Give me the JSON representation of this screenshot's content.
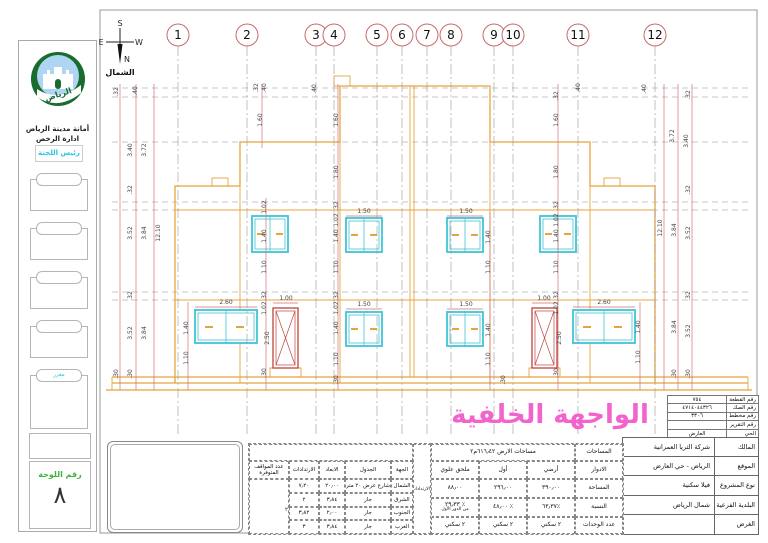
{
  "page": {
    "facade_title": "الواجهة الخلفية"
  },
  "sidebar": {
    "authority_line1": "أمانة مدينة الرياض",
    "authority_line2": "ادارة الرخص",
    "committee_head": "رئيس اللجنة",
    "logo_script": "الرياض",
    "stamp_tab_label": "مقرر"
  },
  "sheet_box": {
    "label": "رقم اللوحة",
    "number": "٨"
  },
  "compass": {
    "n": "N",
    "s": "S",
    "e": "E",
    "w": "W",
    "label": "الشمال"
  },
  "drawing": {
    "grid_bubbles": [
      {
        "n": "1",
        "x": 178
      },
      {
        "n": "2",
        "x": 247
      },
      {
        "n": "3",
        "x": 316
      },
      {
        "n": "4",
        "x": 334
      },
      {
        "n": "5",
        "x": 377
      },
      {
        "n": "6",
        "x": 402
      },
      {
        "n": "7",
        "x": 427
      },
      {
        "n": "8",
        "x": 451
      },
      {
        "n": "9",
        "x": 494
      },
      {
        "n": "10",
        "x": 513
      },
      {
        "n": "11",
        "x": 578
      },
      {
        "n": "12",
        "x": 655
      }
    ],
    "dim_labels": [
      [
        ".32",
        118,
        92,
        1
      ],
      [
        ".40",
        137,
        91,
        1
      ],
      [
        "3.40",
        132,
        150,
        1
      ],
      [
        "3.72",
        146,
        150,
        1
      ],
      [
        ".32",
        132,
        190,
        1
      ],
      [
        "3.52",
        132,
        233,
        1
      ],
      [
        "3.84",
        146,
        233,
        1
      ],
      [
        "12.10",
        160,
        233,
        1
      ],
      [
        ".32",
        132,
        296,
        1
      ],
      [
        "3.52",
        132,
        333,
        1
      ],
      [
        "3.84",
        146,
        333,
        1
      ],
      [
        ".30",
        132,
        374,
        1
      ],
      [
        ".30",
        118,
        374,
        1
      ],
      [
        ".32",
        690,
        95,
        1
      ],
      [
        ".40",
        646,
        89,
        1
      ],
      [
        ".40",
        580,
        88,
        1
      ],
      [
        "3.40",
        688,
        141,
        1
      ],
      [
        "3.72",
        674,
        136,
        1
      ],
      [
        ".32",
        690,
        190,
        1
      ],
      [
        "3.52",
        690,
        233,
        1
      ],
      [
        "3.84",
        676,
        230,
        1
      ],
      [
        "12.10",
        662,
        228,
        1
      ],
      [
        ".32",
        690,
        296,
        1
      ],
      [
        "3.52",
        690,
        331,
        1
      ],
      [
        "3.84",
        676,
        327,
        1
      ],
      [
        ".30",
        690,
        374,
        1
      ],
      [
        ".30",
        676,
        374,
        1
      ],
      [
        ".32",
        258,
        88,
        1
      ],
      [
        ".40",
        266,
        88,
        1
      ],
      [
        "1.60",
        262,
        120,
        1
      ],
      [
        ".40",
        316,
        89,
        1
      ],
      [
        "1.60",
        338,
        120,
        1
      ],
      [
        "1.80",
        338,
        172,
        1
      ],
      [
        ".32",
        338,
        206,
        1
      ],
      [
        "1.02",
        338,
        220,
        1
      ],
      [
        "1.40",
        338,
        236,
        1
      ],
      [
        "1.10",
        338,
        267,
        1
      ],
      [
        ".32",
        338,
        296,
        1
      ],
      [
        "1.02",
        338,
        308,
        1
      ],
      [
        "1.40",
        338,
        328,
        1
      ],
      [
        "1.10",
        338,
        359,
        1
      ],
      [
        ".30",
        338,
        380,
        1
      ],
      [
        ".32",
        558,
        96,
        1
      ],
      [
        "1.60",
        558,
        120,
        1
      ],
      [
        "1.80",
        558,
        172,
        1
      ],
      [
        ".32",
        558,
        206,
        1
      ],
      [
        "1.02",
        558,
        220,
        1
      ],
      [
        "1.40",
        558,
        236,
        1
      ],
      [
        "1.10",
        558,
        267,
        1
      ],
      [
        ".32",
        558,
        296,
        1
      ],
      [
        "1.02",
        558,
        308,
        1
      ],
      [
        "2.50",
        561,
        338,
        1
      ],
      [
        ".30",
        558,
        373,
        1
      ],
      [
        "1.02",
        266,
        207,
        1
      ],
      [
        "1.40",
        266,
        236,
        1
      ],
      [
        "1.10",
        266,
        267,
        1
      ],
      [
        ".32",
        266,
        296,
        1
      ],
      [
        "1.02",
        266,
        308,
        1
      ],
      [
        "2.50",
        269,
        338,
        1
      ],
      [
        ".30",
        266,
        373,
        1
      ],
      [
        "1.40",
        188,
        328,
        1
      ],
      [
        "1.10",
        188,
        358,
        1
      ],
      [
        "1.40",
        490,
        237,
        1
      ],
      [
        "1.10",
        490,
        267,
        1
      ],
      [
        "1.40",
        490,
        330,
        1
      ],
      [
        "1.10",
        490,
        359,
        1
      ],
      [
        "1.40",
        640,
        327,
        1
      ],
      [
        "1.10",
        640,
        357,
        1
      ],
      [
        ".30",
        505,
        380,
        1
      ],
      [
        "2.60",
        226,
        304,
        0
      ],
      [
        "1.00",
        286,
        300,
        0
      ],
      [
        "2.60",
        604,
        304,
        0
      ],
      [
        "1.00",
        544,
        300,
        0
      ],
      [
        "1.50",
        364,
        213,
        0
      ],
      [
        "1.50",
        466,
        213,
        0
      ],
      [
        "1.50",
        364,
        306,
        0
      ],
      [
        "1.50",
        466,
        306,
        0
      ]
    ]
  },
  "info_table": {
    "rows": [
      {
        "label": "رقم القطعة",
        "value": "٧٥٤"
      },
      {
        "label": "رقم الصك",
        "value": "٤٧١٤٠٤٤٣٢٦"
      },
      {
        "label": "رقم مخطط",
        "value": "٣٣٠٦"
      },
      {
        "label": "رقم التقرير",
        "value": ""
      },
      {
        "label": "الحي",
        "value": "العارض"
      }
    ]
  },
  "title_block": {
    "rows": [
      {
        "label": "المالك",
        "value": "شركة الثريا العمرانية"
      },
      {
        "label": "الموقع",
        "value": "الرياض  -  حي العارض"
      },
      {
        "label": "نوع المشروع",
        "value": "فيلا سكنية"
      },
      {
        "label": "البلدية الفرعية",
        "value": "شمال الرياض"
      },
      {
        "label": "الغرض",
        "value": ""
      }
    ]
  },
  "areas_table": {
    "title_label": "المساحات",
    "title_value": "مساحات الارض ٦١٦٫٤٢م٢",
    "row_labels": {
      "floors": "الادوار",
      "area": "المساحة",
      "ratio": "النسبة",
      "units": "عدد الوحدات"
    },
    "columns": [
      {
        "floor": "أرضي",
        "area": "٣٩٠٫٠٠",
        "ratio": "٪٦٣٫٣٧",
        "ratio_sub": "",
        "units": "٢ سكني"
      },
      {
        "floor": "أول",
        "area": "٢٩٦٫٠٠",
        "ratio": "٪ ٤٨٫٠٠",
        "ratio_sub": "",
        "units": "٢ سكني"
      },
      {
        "floor": "ملحق علوي",
        "area": "٨٨٫٠٠",
        "ratio": "٪ ٢٩٫٣٣",
        "ratio_sub": "من الدور الأول",
        "units": "٢ سكني"
      }
    ]
  },
  "setbacks_table": {
    "title": "الارتدادات",
    "headers": {
      "side": "الجهة",
      "boundary": "الجدول",
      "dims": "الابعاد",
      "setbacks": "الارتدادات",
      "parking": "عدد المواقف المتوفرة"
    },
    "parking_value": "٢",
    "rows": [
      {
        "side": "الشمال",
        "boundary": "شارع عرض ٢٠ متر",
        "dim": "٢٠٫٠٠",
        "setback": "٧٫٢٠"
      },
      {
        "side": "الشرق",
        "boundary": "جار",
        "dim": "٣٫٨٤",
        "setback": "٢"
      },
      {
        "side": "الجنوب",
        "boundary": "جار",
        "dim": "٢٫٠٠",
        "setback": "٣٫٨٢"
      },
      {
        "side": "الغرب",
        "boundary": "جار",
        "dim": "٣٫٨٤",
        "setback": "٣"
      }
    ]
  }
}
